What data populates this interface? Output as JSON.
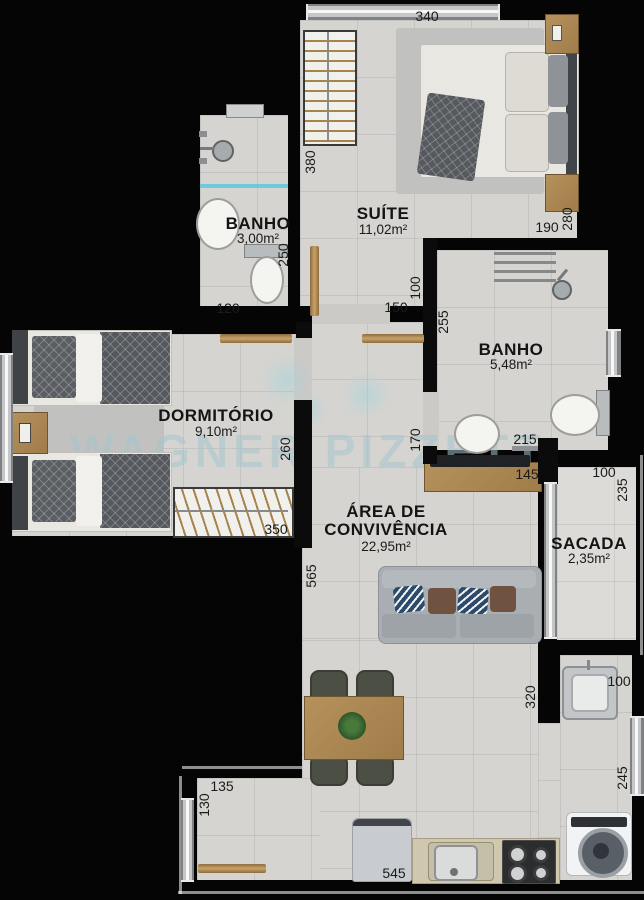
{
  "plan_title": "apartment-floor-plan",
  "watermark": {
    "text": "WAGNER PIZZETTI"
  },
  "rooms": {
    "suite": {
      "name": "SUÍTE",
      "area": "11,02m²"
    },
    "banho_suite": {
      "name": "BANHO",
      "area": "3,00m²"
    },
    "banho_social": {
      "name": "BANHO",
      "area": "5,48m²"
    },
    "dormitorio": {
      "name": "DORMITÓRIO",
      "area": "9,10m²"
    },
    "area_convivencia": {
      "name_line1": "ÁREA DE",
      "name_line2": "CONVIVÊNCIA",
      "area": "22,95m²"
    },
    "sacada": {
      "name": "SACADA",
      "area": "2,35m²"
    }
  },
  "dimensions": {
    "suite_window": "340",
    "suite_left": "380",
    "suite_foot": "190",
    "suite_right": "280",
    "banho_suite_height": "250",
    "banho_suite_width": "120",
    "suite_door_opening": "150",
    "hall_width": "100",
    "banho_social_left": "255",
    "banho_social_door": "170",
    "banho_social_bottom": "215",
    "sideboard_width": "145",
    "sacada_top": "100",
    "sacada_right": "235",
    "dormitorio_right": "260",
    "dormitorio_wardrobe": "350",
    "living_left": "565",
    "laundry_wall": "320",
    "laundry_top": "100",
    "kitchen_window": "245",
    "kitchen_step_width": "135",
    "kitchen_step_left": "130",
    "kitchen_bottom": "545"
  },
  "colors": {
    "background": "#000000",
    "wall": "#0b0b0b",
    "floor": "#d5d4d1",
    "wood": "#b08d5e",
    "watermark": "#a5c5cd",
    "shower_glass": "#5ac8dc"
  }
}
